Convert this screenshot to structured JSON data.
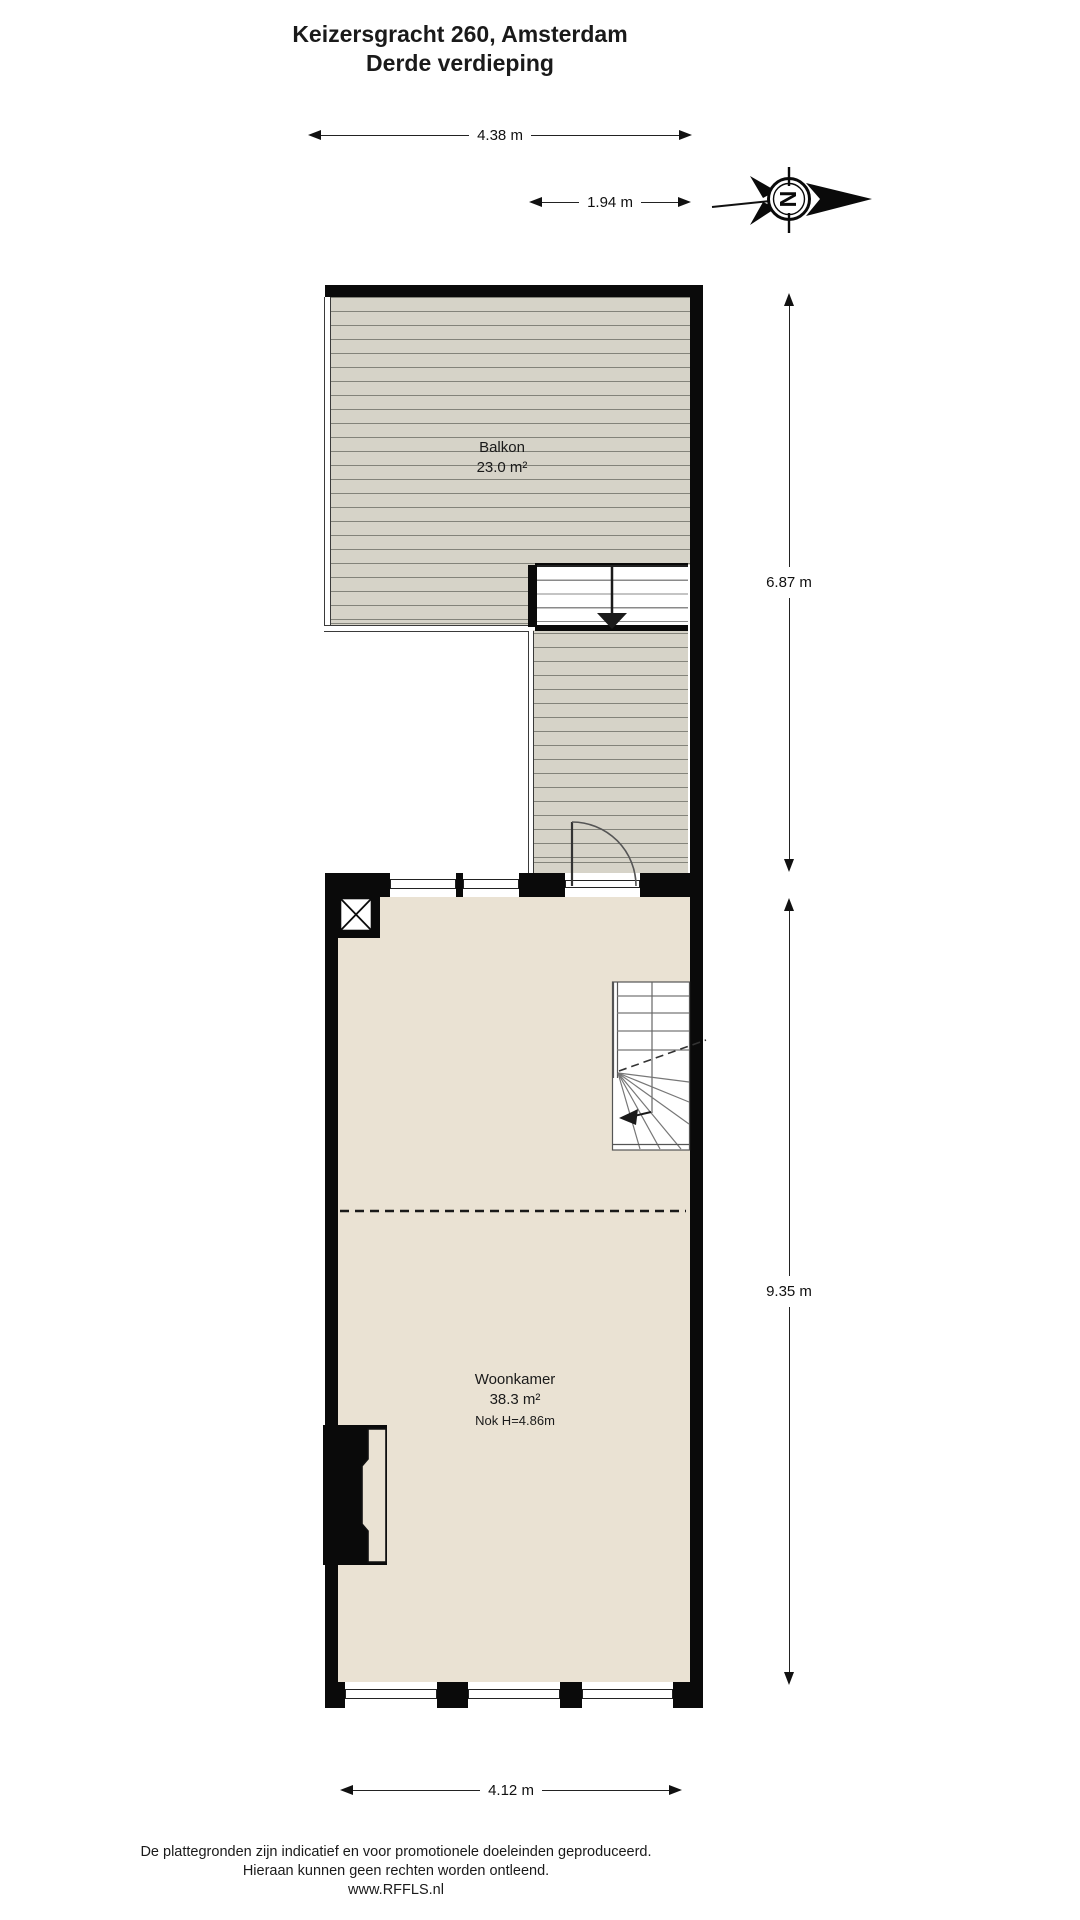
{
  "header": {
    "address": "Keizersgracht 260, Amsterdam",
    "floor": "Derde verdieping"
  },
  "compass": {
    "letter": "N",
    "points": "right"
  },
  "dimensions": {
    "balcony_width": "4.38 m",
    "stairwell_width": "1.94 m",
    "upper_section_height": "6.87 m",
    "lower_section_height": "9.35 m",
    "living_width": "4.12 m"
  },
  "rooms": {
    "balcony": {
      "name": "Balkon",
      "area": "23.0 m²"
    },
    "living_room": {
      "name": "Woonkamer",
      "area": "38.3 m²",
      "ridge_height": "Nok H=4.86m"
    }
  },
  "footer": {
    "disclaimer_line1": "De plattegronden zijn indicatief en voor promotionele doeleinden geproduceerd.",
    "disclaimer_line2": "Hieraan kunnen geen rechten worden ontleend.",
    "website": "www.RFFLS.nl"
  },
  "colors": {
    "wall": "#0a0a0a",
    "deck_fill": "#d6d3c8",
    "deck_line": "#83837a",
    "floor_fill": "#eae2d3",
    "dimension": "#111111",
    "background": "#ffffff"
  }
}
